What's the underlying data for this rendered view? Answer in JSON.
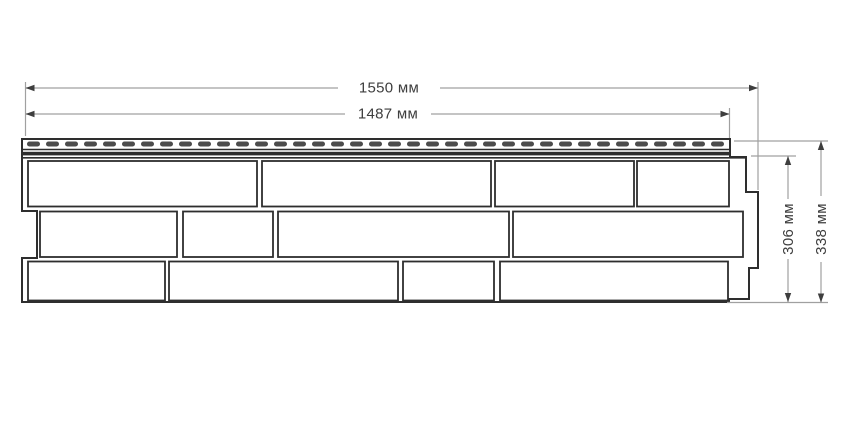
{
  "page": {
    "background": "#ffffff"
  },
  "diagram": {
    "type": "technical-drawing",
    "subject": "brick-textured facade siding panel, front view with dimension callouts",
    "dimension_labels": {
      "total_width": "1550 мм",
      "nailing_strip_width": "1487 мм",
      "panel_field_height": "306 мм",
      "total_height": "338 мм"
    },
    "colors": {
      "outline": "#2e2e2e",
      "brick_fill": "#ffffff",
      "slot_fill": "#4c4c4c",
      "dimension_line": "#a0a0a0",
      "dimension_text": "#3e3e3e",
      "background": "#ffffff"
    },
    "nailing_strip": {
      "slot_count": 37,
      "x_start": 27,
      "pitch": 19,
      "slot_width": 13,
      "slot_height": 5,
      "slot_y": 141.5,
      "slot_radius": 2.5
    },
    "brick_rows": [
      {
        "y": 161,
        "height": 45.5,
        "bricks": [
          [
            28,
            229
          ],
          [
            262,
            229
          ],
          [
            495,
            139
          ],
          [
            637,
            92
          ]
        ]
      },
      {
        "y": 211.5,
        "height": 45.5,
        "bricks": [
          [
            40,
            137
          ],
          [
            183,
            90
          ],
          [
            278,
            231
          ],
          [
            513,
            230
          ]
        ]
      },
      {
        "y": 261.5,
        "height": 39,
        "bricks": [
          [
            28,
            137
          ],
          [
            169,
            229
          ],
          [
            403,
            91
          ],
          [
            500,
            228
          ]
        ]
      }
    ]
  }
}
